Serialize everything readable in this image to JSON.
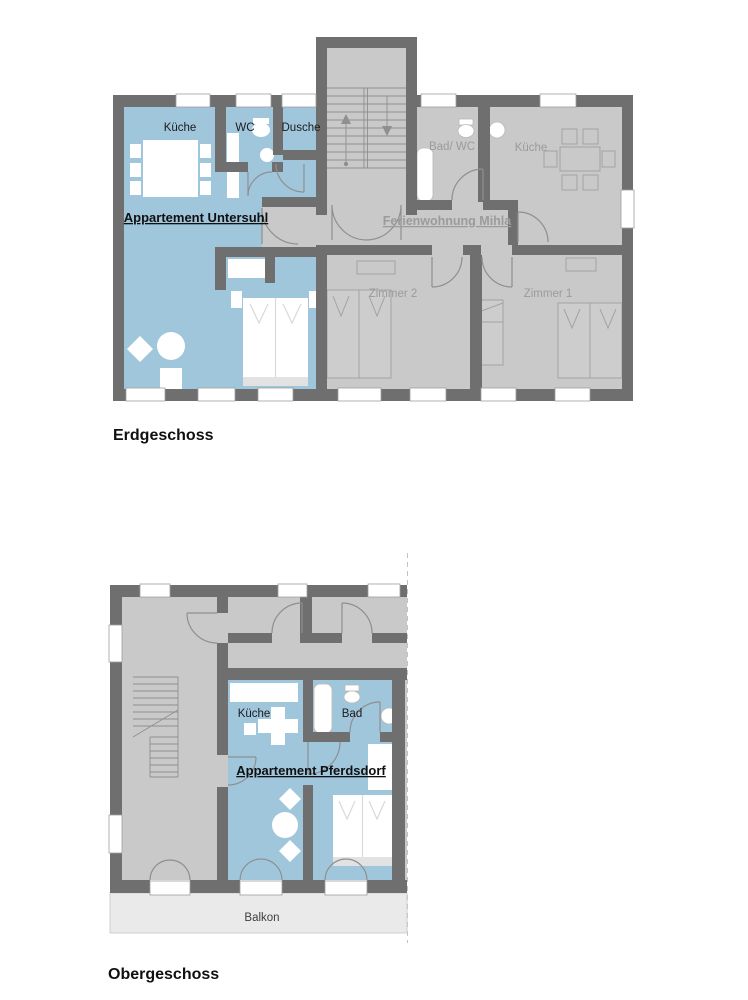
{
  "document": {
    "type": "floor-plan-drawing",
    "background": "#ffffff"
  },
  "colors": {
    "wall": "#6f6f6f",
    "room_gray": "#c9c9c9",
    "apartment_blue": "#a0c6dc",
    "balcony_gray": "#eaeaea",
    "gray_label": "#9b9b9b",
    "black_label": "#1c1c1c"
  },
  "floors": [
    {
      "title": "Erdgeschoss",
      "apartments": [
        {
          "name": "Appartement Untersuhl",
          "color": "#a0c6dc"
        },
        {
          "name": "Ferienwohnung Mihla",
          "color": "#c9c9c9"
        }
      ],
      "rooms": {
        "kueche_left": "Küche",
        "wc": "WC",
        "dusche": "Dusche",
        "bad_wc": "Bad/ WC",
        "kueche_right": "Küche",
        "zimmer2": "Zimmer 2",
        "zimmer1": "Zimmer 1"
      }
    },
    {
      "title": "Obergeschoss",
      "apartments": [
        {
          "name": "Appartement Pferdsdorf",
          "color": "#a0c6dc"
        }
      ],
      "rooms": {
        "kueche": "Küche",
        "bad": "Bad",
        "balkon": "Balkon"
      }
    }
  ]
}
